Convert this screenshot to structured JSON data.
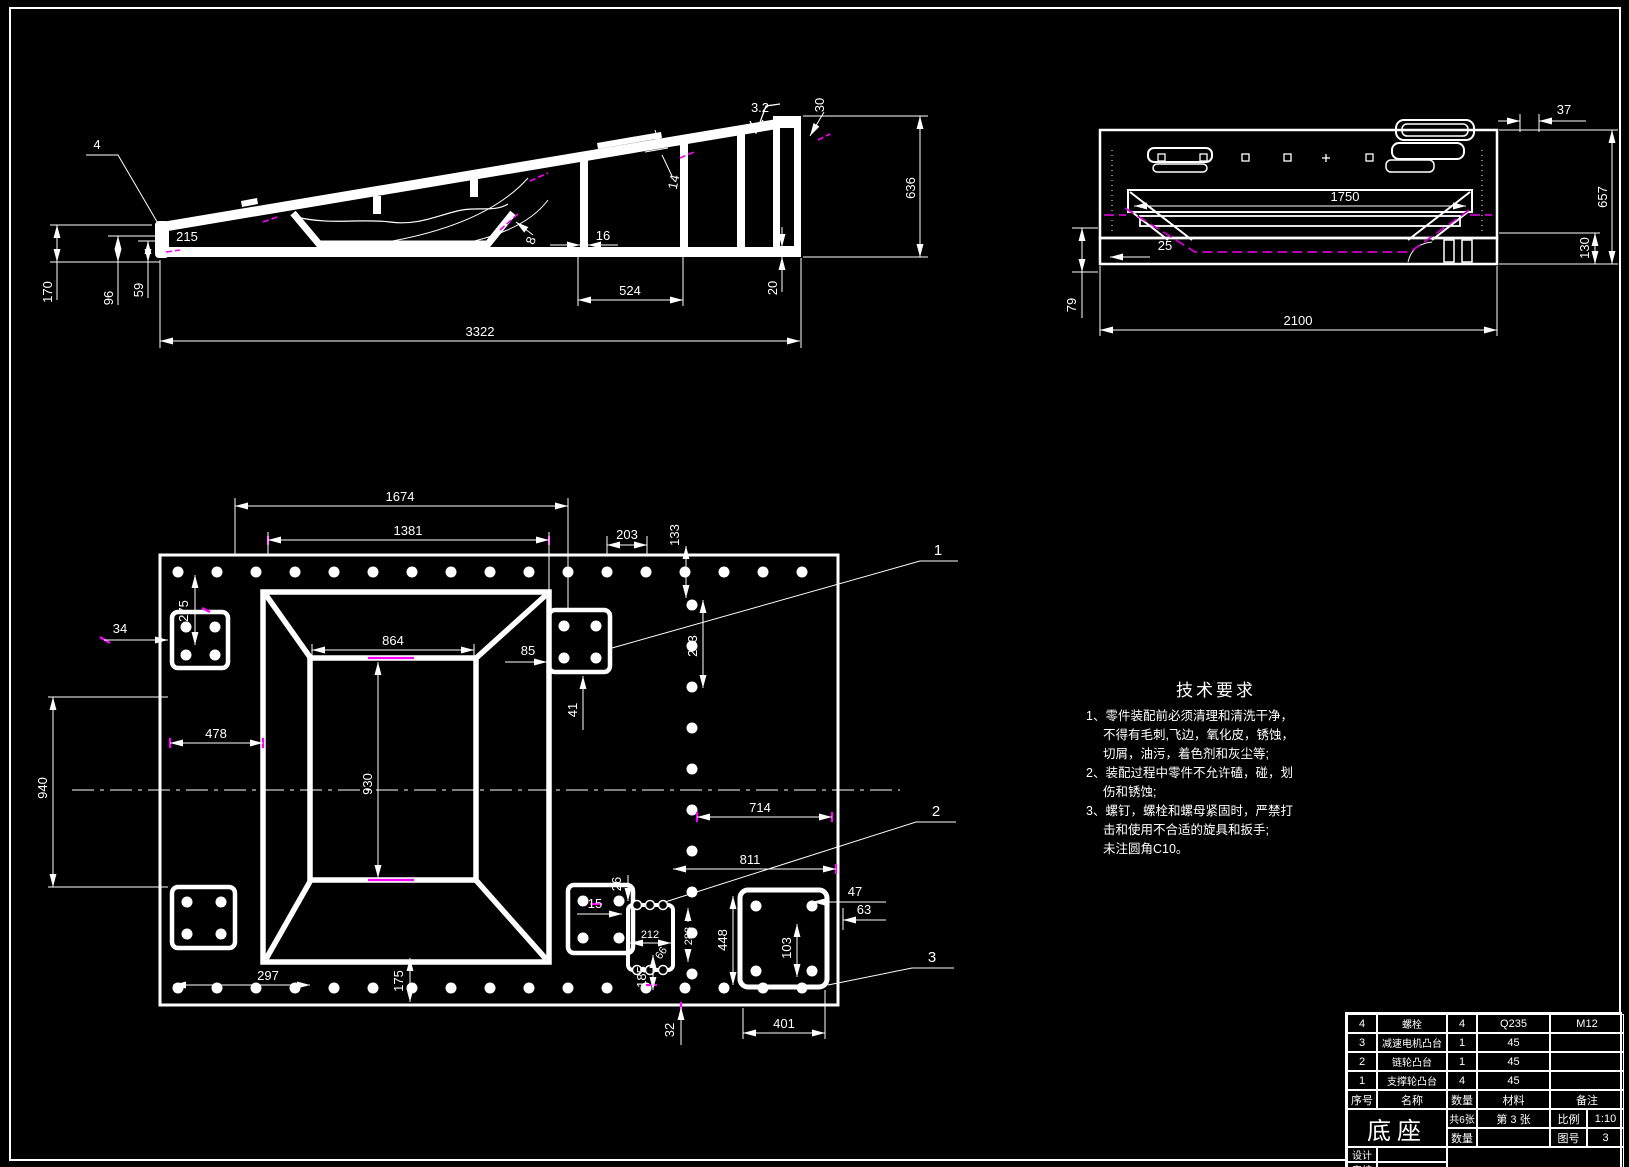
{
  "colors": {
    "background": "#000000",
    "line": "#ffffff",
    "accent_magenta": "#ff00ff"
  },
  "side_view": {
    "dims": {
      "part_leader": "4",
      "height_170": "170",
      "height_96": "96",
      "height_59": "59",
      "len_215": "215",
      "len_524": "524",
      "len_3322": "3322",
      "thk_16": "16",
      "thk_20": "20",
      "thk_14": "14",
      "thk_30": "30",
      "height_636": "636",
      "angle_8": "8",
      "roughness": "3.2"
    }
  },
  "end_view": {
    "dims": {
      "len_37": "37",
      "height_657": "657",
      "height_130": "130",
      "len_25": "25",
      "height_79": "79",
      "len_2100": "2100",
      "len_1750": "1750"
    }
  },
  "plan_view": {
    "dims": {
      "len_1674": "1674",
      "len_1381": "1381",
      "pitch_203": "203",
      "len_133": "133",
      "len_275": "275",
      "len_864": "864",
      "len_34": "34",
      "len_478": "478",
      "len_940": "940",
      "len_930": "930",
      "pitch_203_v": "203",
      "len_41": "41",
      "len_85": "85",
      "len_714": "714",
      "len_811": "811",
      "len_26": "26",
      "len_15": "15",
      "len_212": "212",
      "len_66": "66",
      "len_283": "283",
      "len_448": "448",
      "len_103": "103",
      "len_47": "47",
      "len_63": "63",
      "len_297": "297",
      "len_175": "175",
      "len_185": "185",
      "len_32": "32",
      "len_401": "401"
    },
    "leaders": {
      "one": "1",
      "two": "2",
      "three": "3"
    }
  },
  "tech": {
    "title": "技术要求",
    "lines": [
      "1、零件装配前必须清理和清洗干净，",
      "不得有毛刺,飞边，氧化皮，锈蚀，",
      "切屑，油污，着色剂和灰尘等;",
      "2、装配过程中零件不允许磕，碰，划",
      "伤和锈蚀;",
      "3、螺钉，螺栓和螺母紧固时，严禁打",
      "击和使用不合适的旋具和扳手;",
      "未注圆角C10。"
    ]
  },
  "title_block": {
    "header": {
      "seq": "序号",
      "name": "名称",
      "qty": "数量",
      "material": "材料",
      "remark": "备注"
    },
    "rows": [
      {
        "seq": "4",
        "name": "螺栓",
        "qty": "4",
        "material": "Q235",
        "remark": "M12"
      },
      {
        "seq": "3",
        "name": "减速电机凸台",
        "qty": "1",
        "material": "45",
        "remark": ""
      },
      {
        "seq": "2",
        "name": "链轮凸台",
        "qty": "1",
        "material": "45",
        "remark": ""
      },
      {
        "seq": "1",
        "name": "支撑轮凸台",
        "qty": "4",
        "material": "45",
        "remark": ""
      }
    ],
    "title": "底座",
    "sheet_total": "共6张",
    "sheet_no": "第 3 张",
    "qty_label": "数量",
    "scale_label": "比例",
    "scale_value": "1:10",
    "drawing_no_label": "图号",
    "drawing_no_value": "3",
    "design_label": "设计",
    "check_label": "审核"
  }
}
